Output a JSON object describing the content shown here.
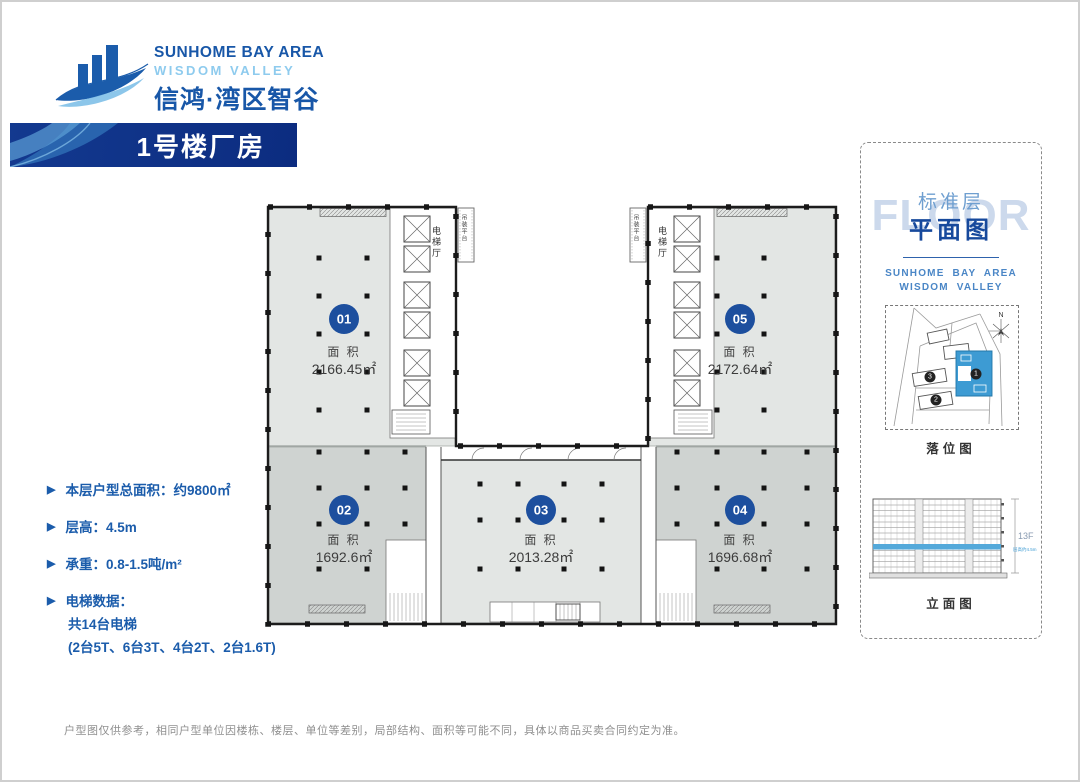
{
  "logo": {
    "line1": "SUNHOME BAY AREA",
    "line2": "WISDOM VALLEY",
    "line3": "信鸿·湾区智谷"
  },
  "banner": {
    "title": "1号楼厂房"
  },
  "info": {
    "items": [
      {
        "label": "本层户型总面积：约9800㎡"
      },
      {
        "label": "层高：4.5m"
      },
      {
        "label": "承重：0.8-1.5吨/m²"
      },
      {
        "label": "电梯数据：",
        "sub1": "共14台电梯",
        "sub2": "(2台5T、6台3T、4台2T、2台1.6T)"
      }
    ]
  },
  "plan": {
    "area_label": "面 积",
    "units": [
      {
        "id": "01",
        "area": "2166.45㎡"
      },
      {
        "id": "02",
        "area": "1692.6㎡"
      },
      {
        "id": "03",
        "area": "2013.28㎡"
      },
      {
        "id": "04",
        "area": "1696.68㎡"
      },
      {
        "id": "05",
        "area": "2172.64㎡"
      }
    ],
    "labels": {
      "elevator_hall": "电梯厅",
      "hoisting_platform": "吊装平台"
    }
  },
  "side_panel": {
    "watermark": "FLOOR",
    "title_line1": "标准层",
    "title_line2": "平面图",
    "brand_line1": "SUNHOME BAY AREA",
    "brand_line2": "WISDOM VALLEY",
    "site_map": {
      "caption": "落位图",
      "north_label": "N",
      "building_1": "1",
      "building_2": "2",
      "building_3": "3"
    },
    "elevation": {
      "caption": "立面图",
      "floors_label": "13F",
      "floor_height_label": "层高约4.5m"
    }
  },
  "footer": {
    "disclaimer": "户型图仅供参考，相同户型单位因楼栋、楼层、单位等差别，局部结构、面积等可能不同，具体以商品买卖合同约定为准。"
  },
  "colors": {
    "brand_blue": "#1857a8",
    "light_blue": "#8ecbee",
    "banner_blue": "#0f338c",
    "badge_blue": "#1d4f9e",
    "unit_fill_light": "#e3e6e4",
    "unit_fill_dark": "#cfd3d1",
    "highlight_blue": "#54a9da"
  }
}
